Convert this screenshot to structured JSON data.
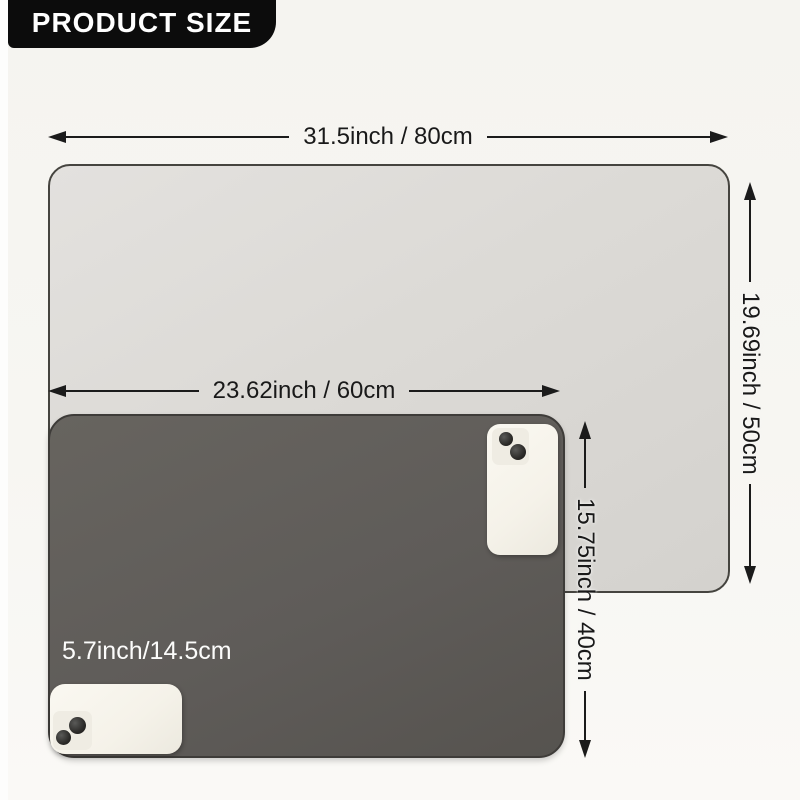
{
  "header": {
    "title": "PRODUCT SIZE"
  },
  "diagram": {
    "large_mat": {
      "width_label": "31.5inch / 80cm",
      "height_label": "19.69inch / 50cm"
    },
    "small_mat": {
      "width_label": "23.62inch / 60cm",
      "height_label": "15.75inch / 40cm"
    },
    "phone": {
      "size_label": "5.7inch/14.5cm"
    }
  },
  "colors": {
    "background": "#f6f5f1",
    "badge_bg": "#0c0c0c",
    "badge_text": "#ffffff",
    "large_mat": "#dcdad6",
    "small_mat": "#5f5c59",
    "arrow": "#1b1b1b",
    "dim_text": "#191919",
    "phone_body": "#f5f2e9",
    "phone_label_text": "#fcfcfb"
  }
}
